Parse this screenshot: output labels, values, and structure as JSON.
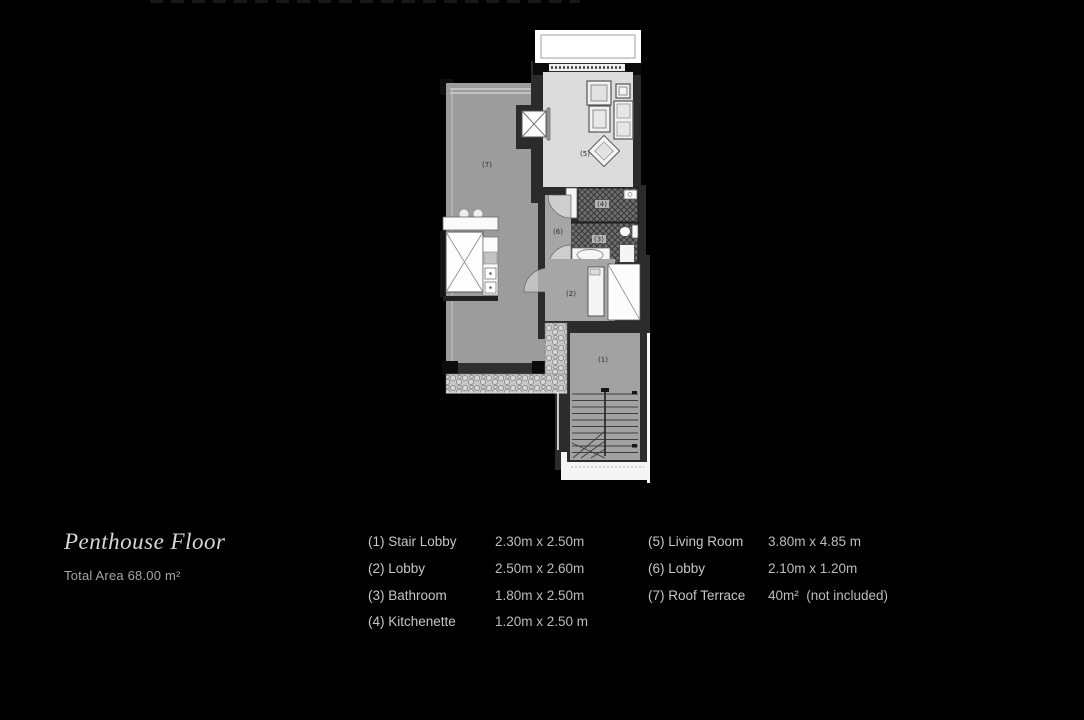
{
  "page": {
    "background": "#000000"
  },
  "title_block": {
    "title": "Penthouse Floor",
    "subtitle": "Total Area 68.00 m²"
  },
  "legend": {
    "col1": [
      {
        "label": "(1) Stair Lobby",
        "dims": "2.30m x 2.50m"
      },
      {
        "label": "(2) Lobby",
        "dims": "2.50m x 2.60m"
      },
      {
        "label": "(3) Bathroom",
        "dims": "1.80m x 2.50m"
      },
      {
        "label": "(4) Kitchenette",
        "dims": "1.20m x 2.50 m"
      }
    ],
    "col2": [
      {
        "label": "(5) Living Room",
        "dims": "3.80m x 4.85 m"
      },
      {
        "label": "(6) Lobby",
        "dims": "2.10m x 1.20m"
      },
      {
        "label": "(7) Roof Terrace",
        "dims": "40m²  (not included)"
      }
    ]
  },
  "plan": {
    "rooms": {
      "r1": "(1)",
      "r2": "(2)",
      "r3": "(3)",
      "r4": "(4)",
      "r5": "(5)",
      "r6": "(6)",
      "r7": "(7)"
    },
    "colors": {
      "terrace": "#9c9c9c",
      "living": "#dcdcdc",
      "lobby": "#a6a6a6",
      "stair": "#a2a2a2",
      "wall": "#2b2b2b",
      "hatch_bg": "#6e6e6e",
      "white_trim": "#f5f5f5"
    }
  }
}
